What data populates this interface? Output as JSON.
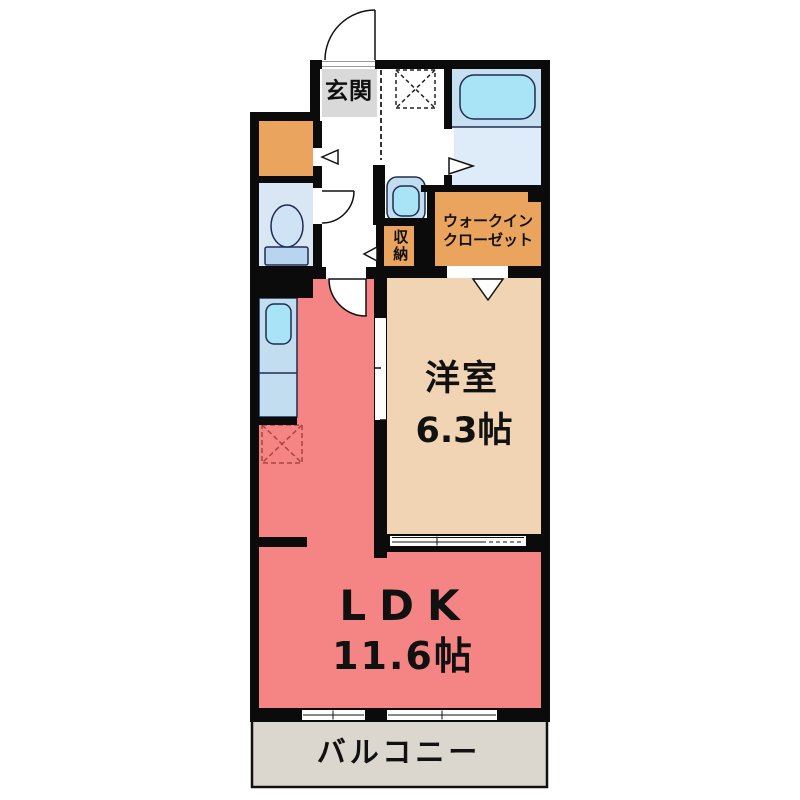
{
  "rooms": {
    "genkan": {
      "label": "玄関"
    },
    "western_room": {
      "label": "洋室",
      "size": "6.3帖"
    },
    "ldk": {
      "label": "LDK",
      "size": "11.6帖"
    },
    "walk_in_closet": {
      "line1": "ウォークイン",
      "line2": "クローゼット"
    },
    "storage": {
      "label": "収納"
    },
    "balcony": {
      "label": "バルコニー"
    }
  },
  "colors": {
    "wall": "#0b0b0b",
    "ldk_pink": "#f58585",
    "western_tan": "#f1d4b4",
    "closet_orange": "#eaa45e",
    "genkan_gray": "#d9d9d9",
    "toilet_room_blue": "#d9e6f3",
    "counter_blue": "#c2dcf0",
    "fixture_cyan": "#a9e4f6",
    "bath_upper_blue": "#c6e0f2",
    "bath_lower_blue": "#deebf8",
    "toilet_tank_blue": "#b9d4ee",
    "toilet_bowl_blue": "#cfe2f6",
    "balcony_beige": "#dbd7ce",
    "fridge_dash_red": "#a94442",
    "text": "#111111"
  }
}
